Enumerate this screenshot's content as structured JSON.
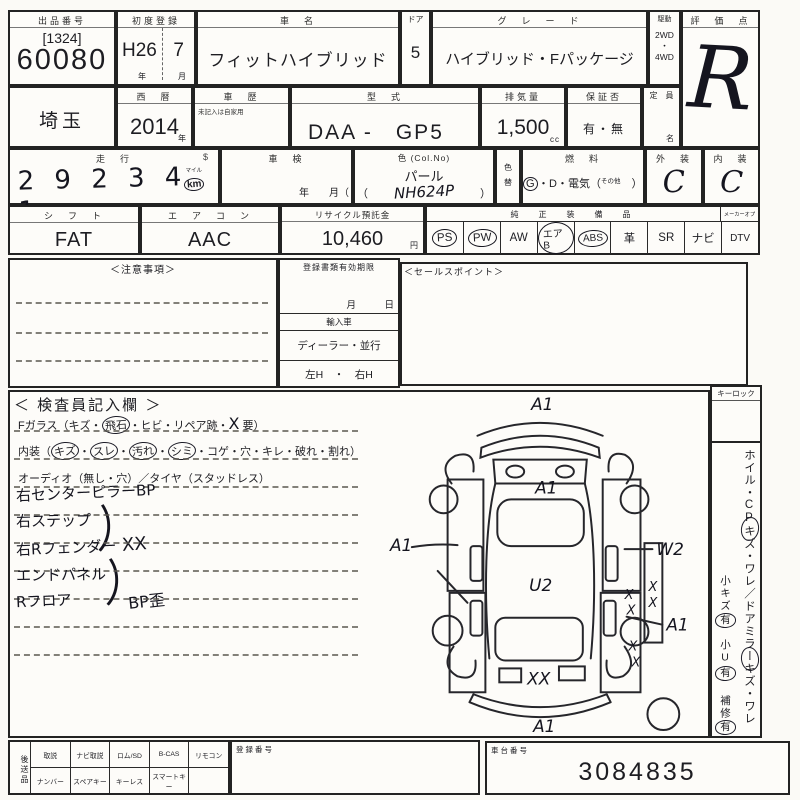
{
  "colors": {
    "ink": "#15151f",
    "line": "#232323",
    "paper": "#fdfcf9"
  },
  "top": {
    "auction": {
      "label": "出品番号",
      "bracket_no": "[1324]",
      "number": "60080"
    },
    "first_reg": {
      "label": "初度登録",
      "era": "H26",
      "month": "7",
      "unit_year": "年",
      "unit_month": "月"
    },
    "car_name": {
      "label": "車　名",
      "value": "フィットハイブリッド"
    },
    "door": {
      "label": "ドア",
      "value": "5"
    },
    "grade": {
      "label": "グ　レ　ー　ド",
      "value": "ハイブリッド・Fパッケージ"
    },
    "drive": {
      "label": "駆動",
      "options": [
        "2WD",
        "・",
        "4WD"
      ]
    },
    "score": {
      "label": "評　価　点",
      "value": "R"
    }
  },
  "row2": {
    "prefecture": "埼玉",
    "year": {
      "label": "西　暦",
      "value": "2014",
      "unit": "年"
    },
    "history": {
      "label": "車　歴",
      "note": "未記入は自家用"
    },
    "model": {
      "label": "型　式",
      "value": "DAA -　GP5"
    },
    "displacement": {
      "label": "排気量",
      "value": "1,500",
      "unit": "cc"
    },
    "warranty": {
      "label": "保証否",
      "value": "有・無"
    },
    "capacity": {
      "label": "定　員",
      "unit": "名"
    }
  },
  "row3": {
    "mileage": {
      "label": "走　行",
      "sign": "$",
      "digits": "2 9 2 3 4 1",
      "unit_top": "マイル",
      "unit": "km"
    },
    "shaken": {
      "label": "車　検",
      "units": "年　　月（"
    },
    "color": {
      "label": "色 (Col.No)",
      "value": "パール",
      "open": "（",
      "code": "NH624P",
      "close": "）"
    },
    "color_change": {
      "top": "色",
      "bottom": "替"
    },
    "fuel": {
      "label": "燃　料",
      "g": "G",
      "rest": "・D・電気（",
      "other": "その他",
      "close": "）"
    },
    "exterior": {
      "label": "外　装",
      "value": "C"
    },
    "interior": {
      "label": "内　装",
      "value": "C"
    }
  },
  "row4": {
    "shift": {
      "label": "シ　フ　ト",
      "value": "FAT"
    },
    "aircon": {
      "label": "エ　ア　コ　ン",
      "value": "AAC"
    },
    "recycle": {
      "label": "リサイクル預託金",
      "value": "10,460",
      "unit": "円"
    },
    "equipment": {
      "label": "純　正　装　備　品",
      "label2": "メーカーオプ",
      "items": [
        {
          "label": "PS",
          "circled": true
        },
        {
          "label": "PW",
          "circled": true
        },
        {
          "label": "AW",
          "circled": false
        },
        {
          "label": "エアB",
          "circled": true
        },
        {
          "label": "ABS",
          "circled": true
        },
        {
          "label": "革",
          "circled": false
        },
        {
          "label": "SR",
          "circled": false
        },
        {
          "label": "ナビ",
          "circled": false
        },
        {
          "label": "DTV",
          "circled": false
        }
      ]
    }
  },
  "row5": {
    "notice": {
      "label": "＜注意事項＞"
    },
    "docs": {
      "label": "登録書類有効期限",
      "month_day": "月　　　日",
      "import_label": "輸入車",
      "dealer": "ディーラー・並行",
      "handle": "左H　・　右H"
    },
    "sales": {
      "label": "＜セールスポイント＞"
    }
  },
  "inspector": {
    "title": "＜ 検査員記入欄 ＞",
    "glass": {
      "prefix": "Fガラス（キズ・",
      "circled": "飛石",
      "mid": "・ヒビ・リペア跡・",
      "hand_x": "X",
      "suffix": "要）"
    },
    "interior_line": {
      "prefix": "内装（",
      "sep": "・",
      "suffix": "）",
      "items": [
        {
          "t": "キズ",
          "c": true
        },
        {
          "t": "スレ",
          "c": true
        },
        {
          "t": "汚れ",
          "c": true
        },
        {
          "t": "シミ",
          "c": true
        },
        {
          "t": "コゲ",
          "c": false
        },
        {
          "t": "穴",
          "c": false
        },
        {
          "t": "キレ",
          "c": false
        },
        {
          "t": "破れ",
          "c": false
        },
        {
          "t": "割れ",
          "c": false
        }
      ]
    },
    "audio_line": "オーディオ（無し・穴）／タイヤ（スタッドレス）",
    "notes": [
      "右センターピラーBP",
      "右ステップ",
      "右Rフェンダー",
      "エンドパネル",
      "Rフロア"
    ],
    "brace": "）",
    "brace1_mark": "XX",
    "brace2_mark": "BP歪",
    "diagram": {
      "a1": "A1",
      "w2": "W2",
      "u2": "U2",
      "xx": "XX",
      "x": "X"
    }
  },
  "sidebar": {
    "keylock": "キーロック",
    "vertical_note": "ホイル・CPキズ・ワレ／ドアミラーキズ・ワレ",
    "small_notes": [
      {
        "label": "小キズ",
        "mark": "有"
      },
      {
        "label": "小U",
        "mark": "有"
      },
      {
        "label": "補修",
        "mark": "有"
      }
    ]
  },
  "bottom": {
    "send_label": "後送品",
    "row1": [
      "取説",
      "ナビ取説",
      "ロム/SD",
      "B-CAS",
      "リモコン"
    ],
    "row2": [
      "ナンバー",
      "スペアキー",
      "キーレス",
      "スマートキー",
      ""
    ],
    "reg": {
      "label": "登録番号"
    },
    "chassis": {
      "label": "車台番号",
      "value": "3084835"
    }
  }
}
